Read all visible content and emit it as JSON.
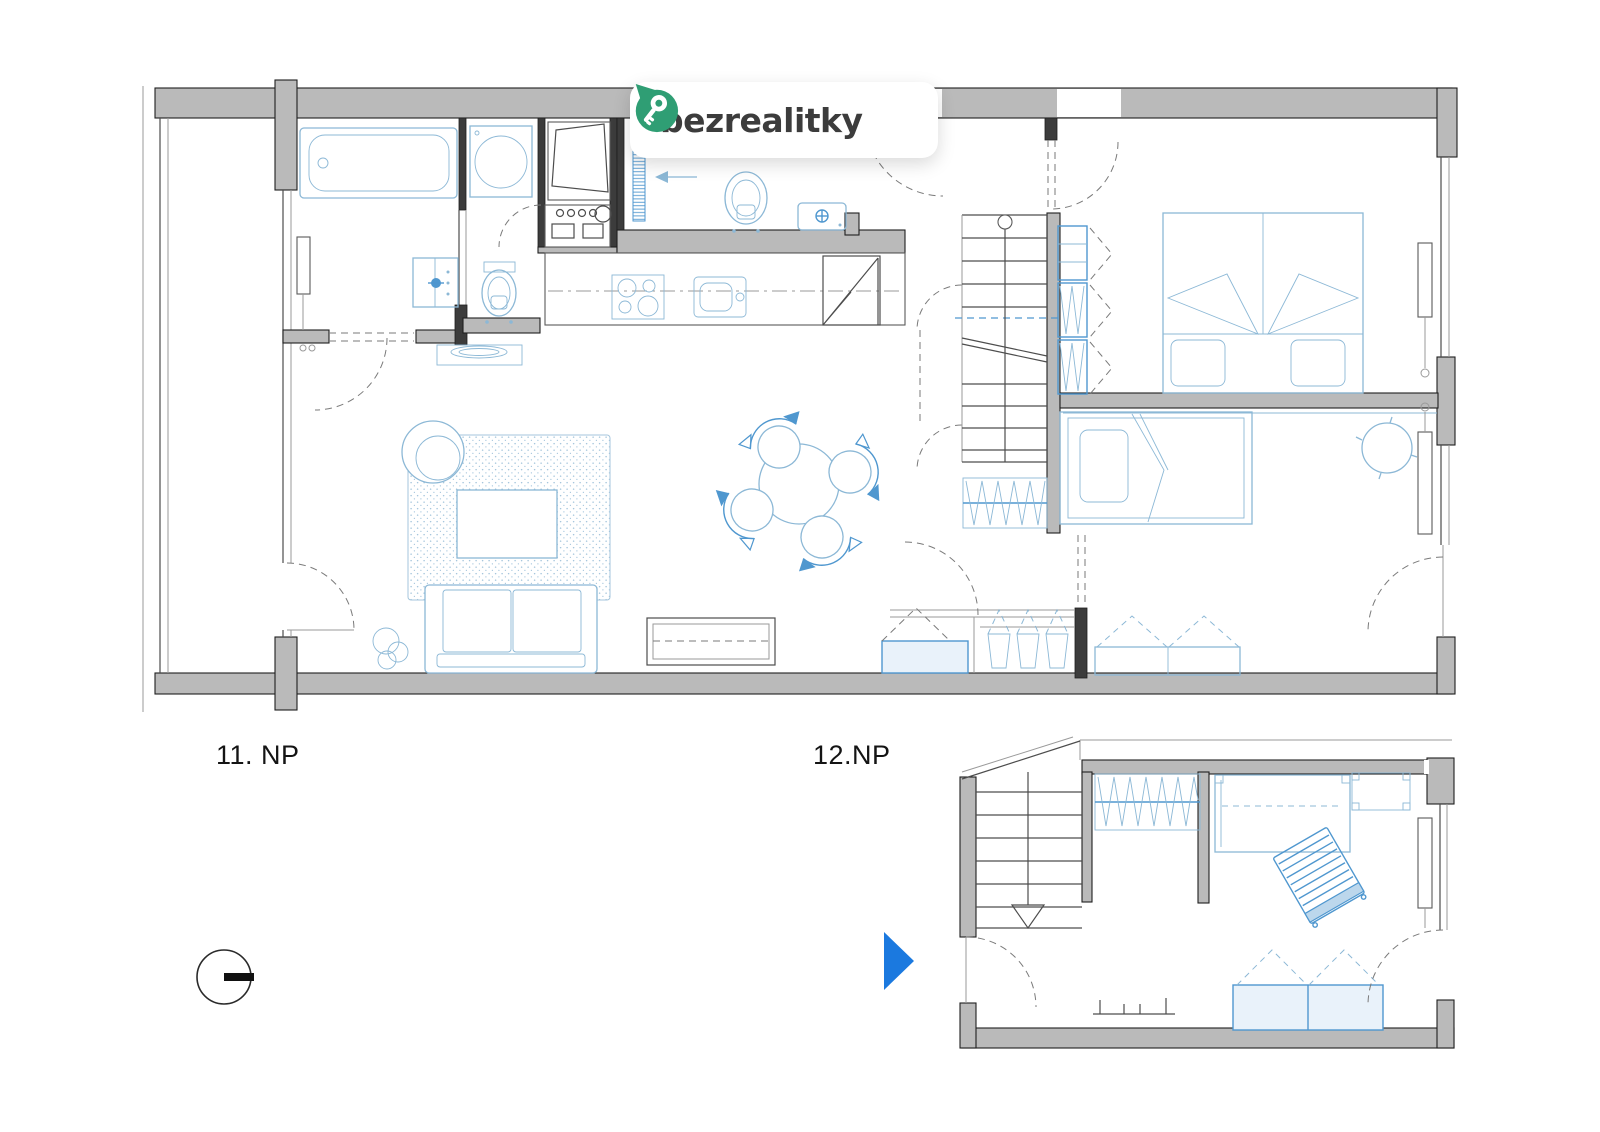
{
  "page": {
    "background": "#ffffff",
    "width": 1600,
    "height": 1132
  },
  "logo": {
    "text": "bezrealitky",
    "pin_color": "#2f9e74",
    "pin_icon": "key-pin-icon"
  },
  "plan": {
    "floors": [
      {
        "id": "11np",
        "label": "11. NP"
      },
      {
        "id": "12np",
        "label": "12.NP"
      }
    ]
  },
  "markers": {
    "north_indicator": "compass-icon",
    "direction_arrow": "play-arrow-icon"
  },
  "colors": {
    "wall_fill": "#bababa",
    "wall_stroke": "#1f1f1f",
    "furniture": "#8cb8d6",
    "accent": "#4f97cf",
    "arrow": "#1b79df",
    "label_color": "#141414",
    "logo_text": "#3c3c3c"
  }
}
